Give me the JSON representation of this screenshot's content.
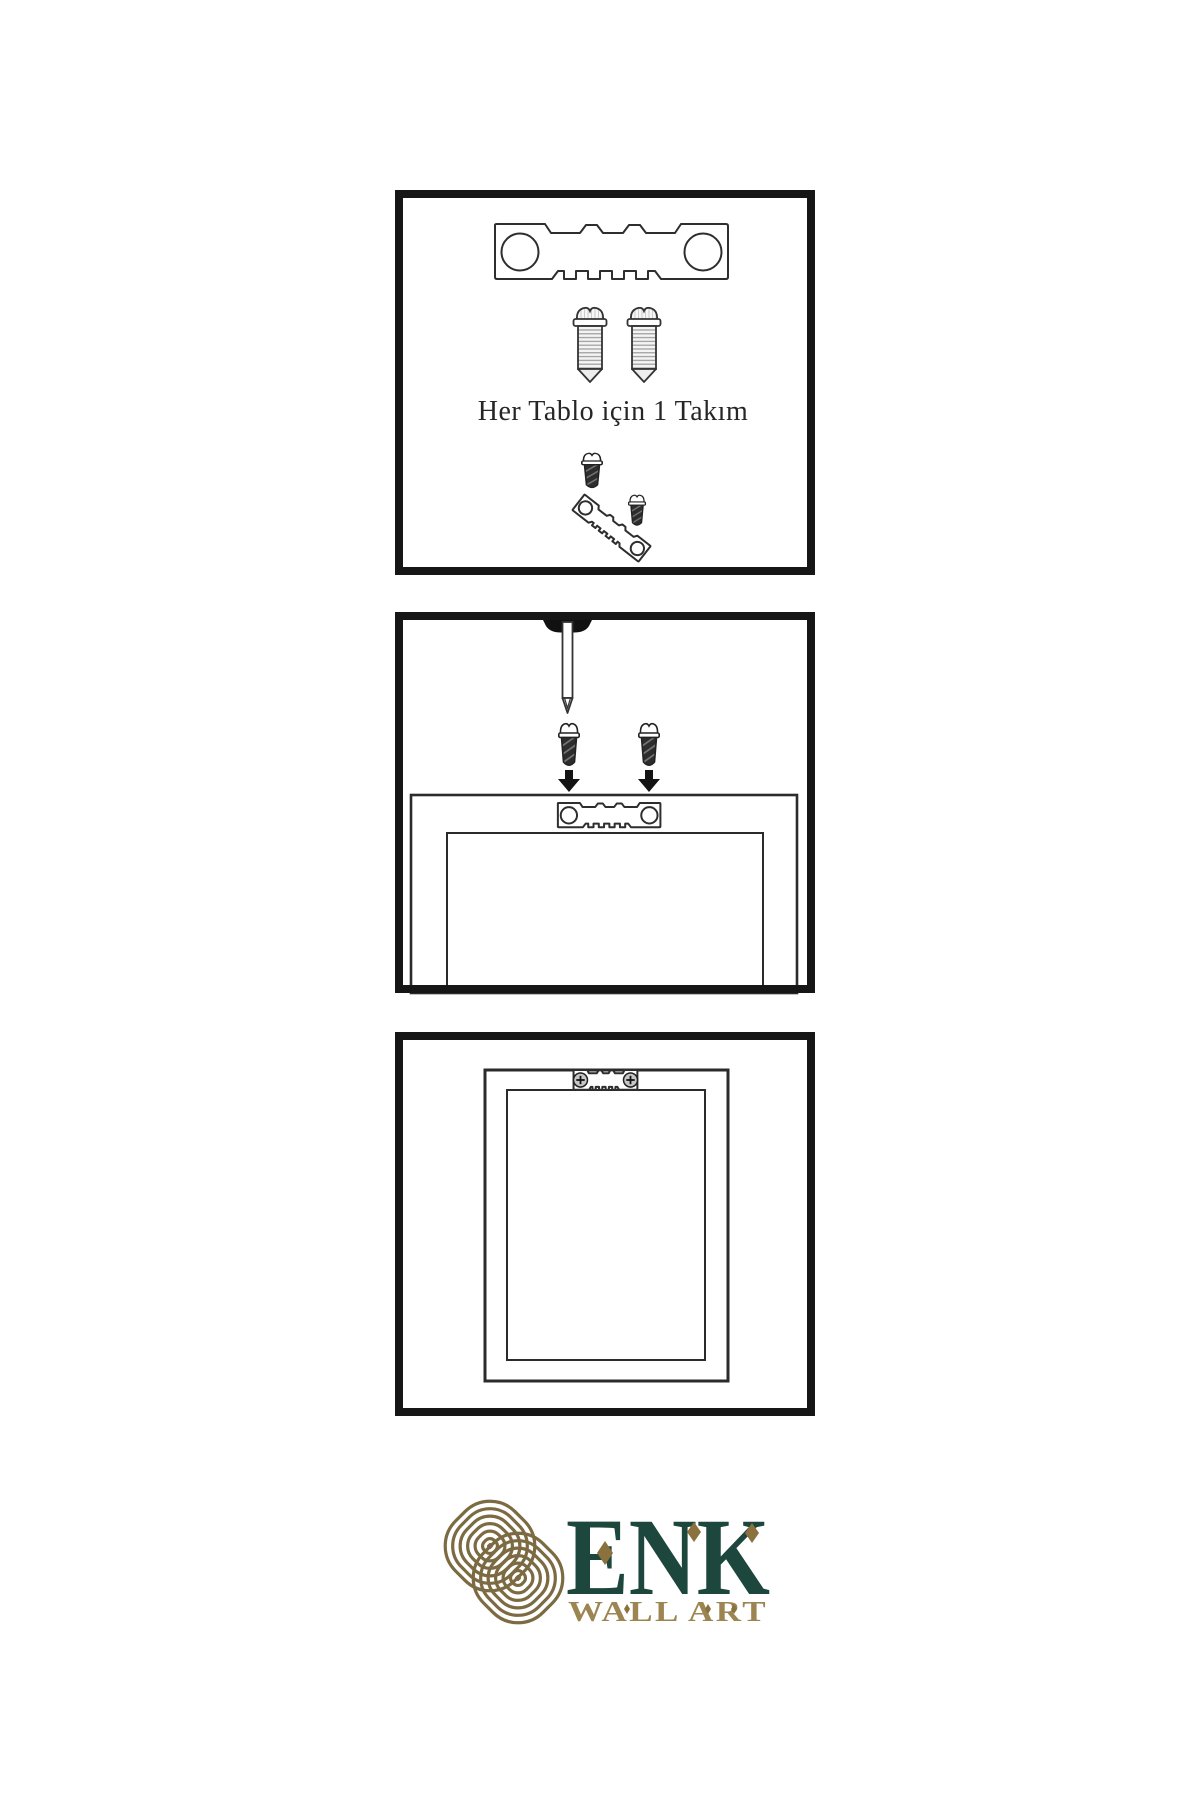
{
  "page": {
    "background": "#ffffff",
    "kind": "product-instruction-sheet"
  },
  "colors": {
    "panel_border": "#161616",
    "line_art": "#2e2e2e",
    "hardware_dark": "#2d2d2d",
    "knot_gold": "#7c6a42",
    "brand_green": "#1d473c",
    "tagline_gold": "#9c8551",
    "accent_gold": "#8a713d"
  },
  "steps": [
    {
      "name": "hardware-kit",
      "caption": "Her Tablo için 1 Takım",
      "illustrations": [
        "sawtooth-hanger",
        "mounting-screw",
        "mounting-screw",
        "sawtooth-hanger-angled-with-screws"
      ]
    },
    {
      "name": "attach-hanger-and-nail-wall",
      "illustrations": [
        "wall-nail",
        "screw-with-down-arrow",
        "screw-with-down-arrow",
        "frame-back-with-sawtooth-hanger"
      ]
    },
    {
      "name": "hang-frame",
      "illustrations": [
        "frame-back-with-mounted-hanger"
      ]
    }
  ],
  "logo": {
    "brand": "ENK",
    "tagline": "WALL ART",
    "mark": "interlaced-knot",
    "accent": "diamond"
  }
}
